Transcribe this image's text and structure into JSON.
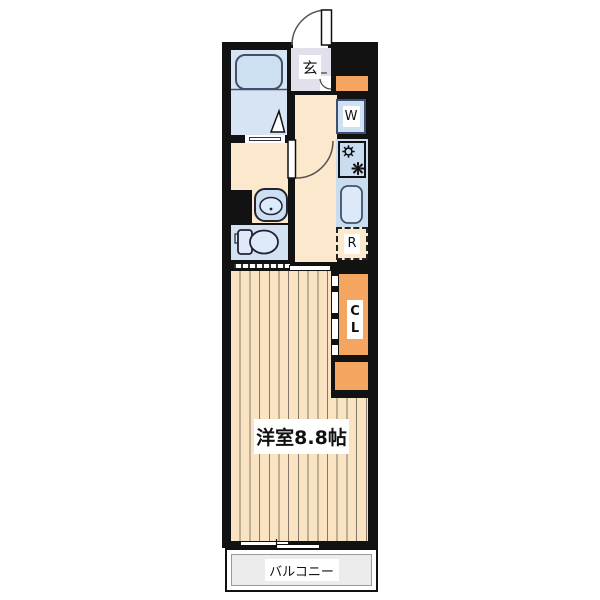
{
  "plan": {
    "type": "apartment-floor-plan",
    "labels": {
      "entrance": "玄",
      "washer": "W",
      "fridge": "R",
      "closet_line1": "C",
      "closet_line2": "L",
      "main_room": "洋室8.8帖",
      "balcony": "バルコニー"
    },
    "icons": {
      "bathtub-icon": "rounded rectangle tub in bathroom",
      "bath-door-icon": "white triangle fold-door marker",
      "entrance-door-arc-icon": "quarter-circle outward swing door",
      "washroom-door-arc-icon": "quarter-circle inward swing door",
      "washbasin-icon": "rounded basin with oval bowl and drain dot",
      "toilet-icon": "tank and bowl symbol",
      "stove-burners-icon": "two gear-like gas burner symbols",
      "kitchen-sink-icon": "rounded rectangle sink",
      "folding-door-icon": "strip with hinge marks beside closet",
      "sliding-door-icon": "hatched track with offset panel",
      "sliding-window-icon": "two offset white window panels"
    },
    "colors": {
      "wall": "#121212",
      "water_blue": "#cfe0f2",
      "counter_blue": "#c9dcf0",
      "toilet_blue": "#d2e2f3",
      "bathroom_blue": "#d6e4f4",
      "floor_cream": "#fce8cc",
      "flooring_wood": "#f9e3c2",
      "flooring_stripe": "#857869",
      "closet_orange": "#f4a55f",
      "genkan_lavender": "#e2e0eb",
      "balcony_gray": "#ececec"
    }
  }
}
